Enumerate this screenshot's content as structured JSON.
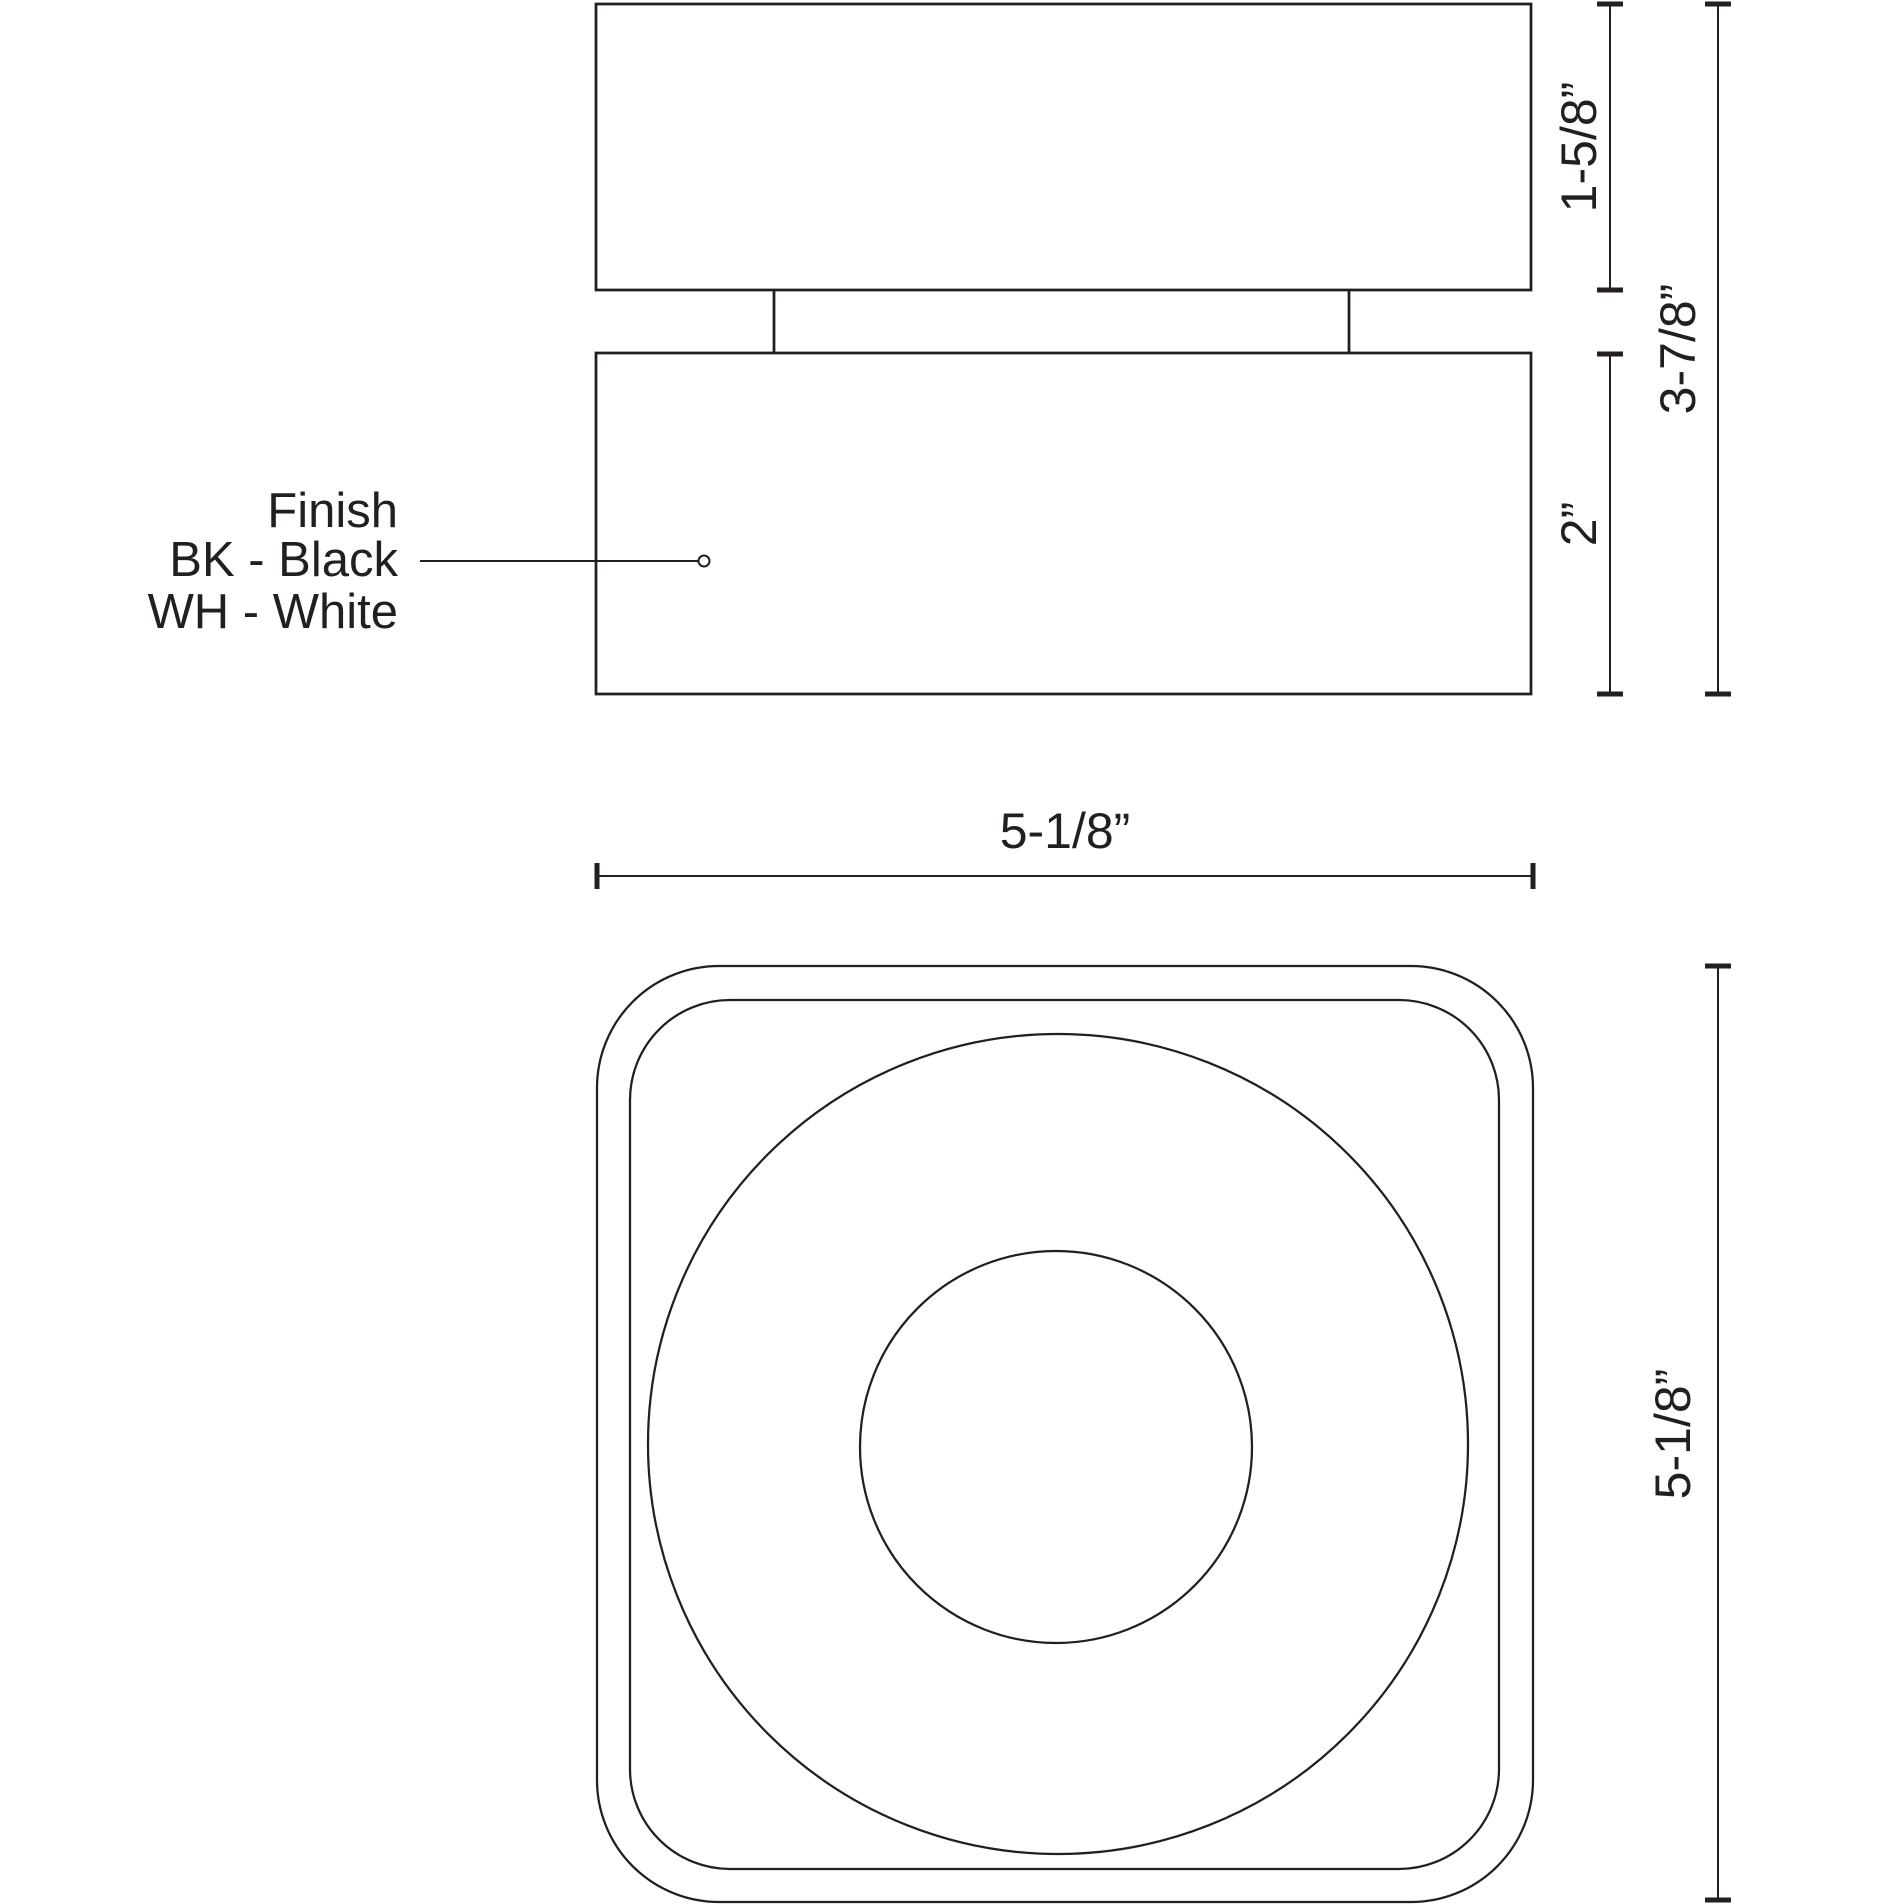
{
  "colors": {
    "line": "#231f20",
    "text": "#231f20",
    "bg": "#ffffff"
  },
  "side_view": {
    "dim_top_height": "1-5/8”",
    "dim_total_height": "3-7/8”",
    "dim_bottom_height": "2”",
    "finish_note": {
      "title": "Finish",
      "option_black": "BK - Black",
      "option_white": "WH - White"
    }
  },
  "top_view": {
    "dim_width": "5-1/8”",
    "dim_height": "5-1/8”"
  }
}
